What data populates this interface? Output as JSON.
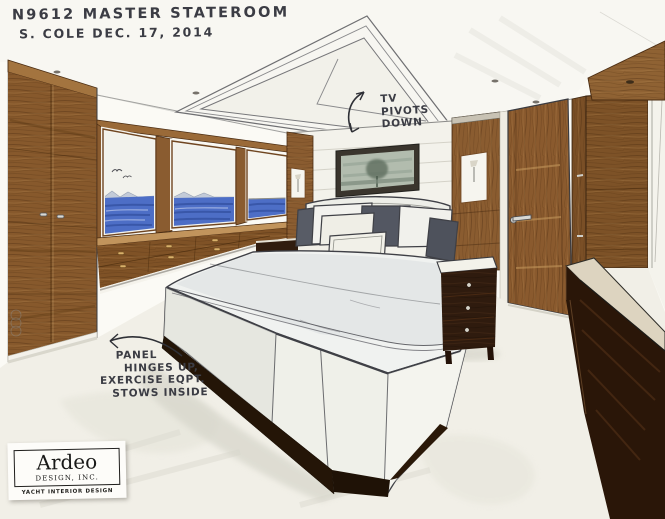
{
  "title": {
    "line1": "N9612  MASTER STATEROOM",
    "line2": "S. COLE  DEC. 17, 2014"
  },
  "annotations": {
    "tv": {
      "lines": [
        "TV",
        "PIVOTS",
        "DOWN"
      ]
    },
    "panel": {
      "lines": [
        "PANEL",
        "HINGES UP,",
        "EXERCISE EQPT.",
        "STOWS INSIDE"
      ]
    }
  },
  "logo": {
    "name": "Ardeo",
    "subtitle": "DESIGN, INC.",
    "tagline": "YACHT INTERIOR DESIGN"
  },
  "scene": {
    "type": "hand-rendered marker and ink concept sketch",
    "subject": "yacht master stateroom interior, one-point perspective",
    "elements": [
      "coffered ceiling tray with pivot-down tv panel",
      "recessed ceiling downlights",
      "port-side tall wood wardrobe",
      "three sea-view windows with partially lowered shade",
      "built-in wood dresser with drawers under windows",
      "upholstered bed with white duvet and charcoal accent pillows",
      "framed misty landscape artwork above headboard",
      "wood pilasters with sconce niches",
      "left and right espresso nightstands",
      "starboard cabin door with lever handle",
      "starboard wood wall panels",
      "foreground espresso low dresser",
      "light carpeted sole",
      "exercise-equipment storage panel note at bed base"
    ],
    "palette": {
      "paper": "#fbfaf5",
      "ink": "#3f4046",
      "pencil": "#8a8a88",
      "wood_mid": "#8a5c30",
      "wood_dark": "#43270c",
      "wood_light": "#c9985c",
      "espresso": "#2a1608",
      "sea_blue": "#4d6ec6",
      "sea_deep": "#33509f",
      "sky": "#f2f2ec",
      "bedding": "#f0f2f0",
      "bedding_shade": "#d8dcde",
      "pillow_charcoal": "#575b64",
      "carpet": "#f1efe7",
      "art_mist": "#b2bcae"
    }
  }
}
